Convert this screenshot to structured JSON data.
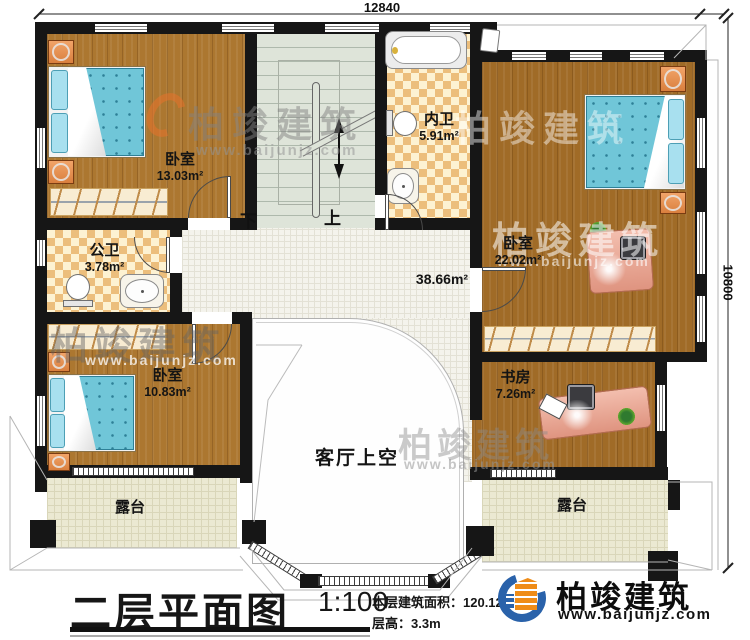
{
  "plan": {
    "dimensions": {
      "top": "12840",
      "right": "10800"
    },
    "rooms": {
      "bedroom_top_left": {
        "name": "卧室",
        "area": "13.03m²"
      },
      "public_bath": {
        "name": "公卫",
        "area": "3.78m²"
      },
      "inner_bath": {
        "name": "内卫",
        "area": "5.91m²"
      },
      "bedroom_right": {
        "name": "卧室",
        "area": "22.02m²"
      },
      "study": {
        "name": "书房",
        "area": "7.26m²"
      },
      "bedroom_bottom_left": {
        "name": "卧室",
        "area": "10.83m²"
      },
      "terrace_left": {
        "name": "露台"
      },
      "terrace_right": {
        "name": "露台"
      },
      "hall": {
        "area": "38.66m²"
      },
      "living_void": {
        "name": "客厅上空"
      },
      "stairs": {
        "down_label": "下",
        "up_label": "上"
      }
    }
  },
  "title_block": {
    "title": "二层平面图",
    "scale": "1:100",
    "area_text": "本层建筑面积：120.12m²",
    "floor_height_text": "层高：3.3m"
  },
  "brand": {
    "name": "柏竣建筑",
    "website": "www.baijunjz.com"
  },
  "watermark": {
    "name": "柏竣建筑",
    "website": "www.baijunjz.com"
  },
  "colors": {
    "wall": "#161616",
    "wood_floor": "#ac7730",
    "bath_tile": "#ecbe7c",
    "stair_floor": "#dee4d9",
    "terrace_tile": "#ebe9d2",
    "bed_blue": "#70c6d8",
    "brand_blue": "#2a62aa",
    "brand_orange": "#ef8c17"
  }
}
